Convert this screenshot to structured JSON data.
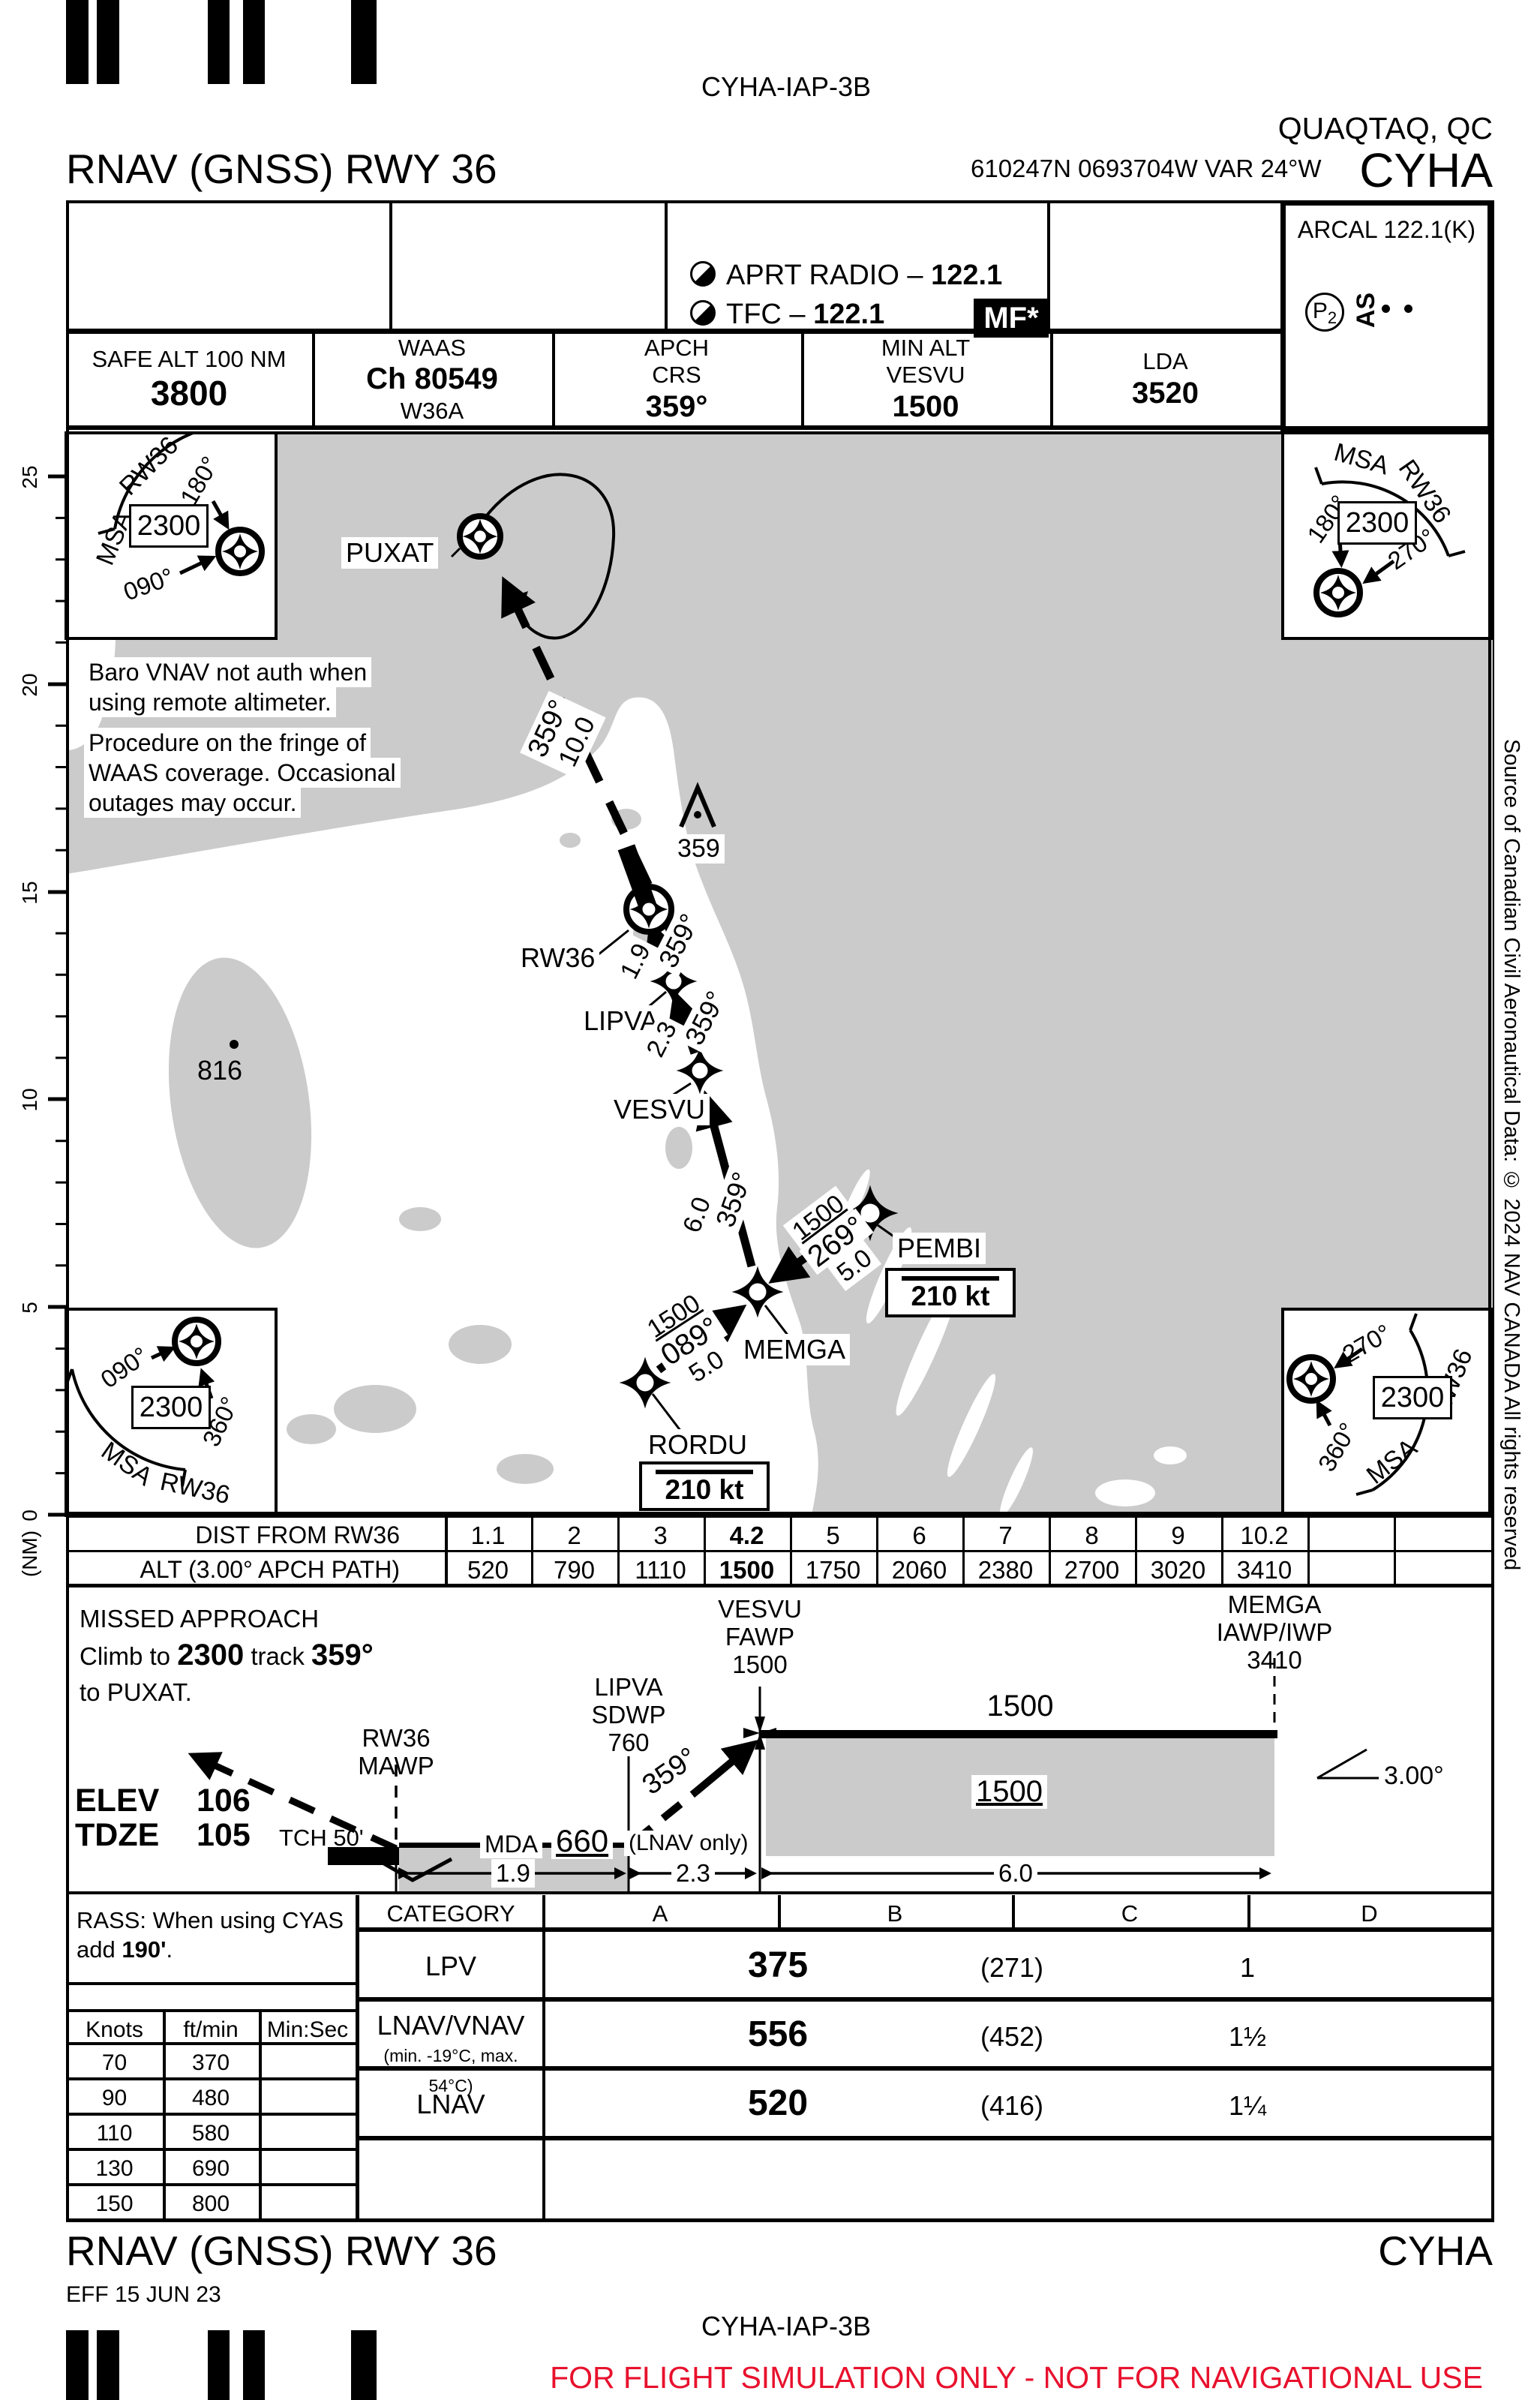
{
  "colors": {
    "warning_red": "#e8112d",
    "land_gray": "#cbcbcb",
    "ink": "#000000"
  },
  "page": {
    "chart_id_top": "CYHA-IAP-3B",
    "city": "QUAQTAQ, QC",
    "airport_code": "CYHA",
    "procedure_title": "RNAV (GNSS) RWY 36",
    "position_line": "610247N  0693704W  VAR 24°W",
    "side_credit": "Source of Canadian Civil Aeronautical Data: © 2024 NAV CANADA All rights reserved",
    "footer_title": "RNAV (GNSS) RWY 36",
    "footer_code": "CYHA",
    "effective": "EFF 15 JUN 23",
    "chart_id_bottom": "CYHA-IAP-3B",
    "warning": "FOR FLIGHT SIMULATION ONLY - NOT FOR NAVIGATIONAL USE"
  },
  "header": {
    "radio_aprt_label": "APRT RADIO – ",
    "radio_aprt_freq": "122.1",
    "radio_tfc_label": "TFC – ",
    "radio_tfc_freq": "122.1",
    "mf_badge": "MF*",
    "arcal": "ARCAL 122.1(K)",
    "p2": "P",
    "p2_sub": "2",
    "as_label": "AS",
    "safe_alt_label": "SAFE ALT 100 NM",
    "safe_alt": "3800",
    "waas_label": "WAAS",
    "waas_channel": "Ch 80549",
    "waas_id": "W36A",
    "apch_label_1": "APCH",
    "apch_label_2": "CRS",
    "apch_crs": "359°",
    "min_alt_label": "MIN ALT",
    "min_alt_fix": "VESVU",
    "min_alt": "1500",
    "lda_label": "LDA",
    "lda": "3520"
  },
  "msa": {
    "title_msa": "MSA",
    "title_rwy": "RW36",
    "altitude": "2300",
    "tl": {
      "b1": "180°",
      "b2": "090°"
    },
    "tr": {
      "b1": "180°",
      "b2": "270°"
    },
    "bl": {
      "b1": "090°",
      "b2": "360°"
    },
    "br": {
      "b1": "270°",
      "b2": "360°"
    }
  },
  "plan": {
    "note1_l1": "Baro VNAV not auth when",
    "note1_l2": "using remote altimeter.",
    "note2_l1": "Procedure on the fringe of",
    "note2_l2": "WAAS coverage. Occasional",
    "note2_l3": "outages may occur.",
    "puxat": "PUXAT",
    "rw36": "RW36",
    "lipva": "LIPVA",
    "vesvu": "VESVU",
    "memga": "MEMGA",
    "pembi": "PEMBI",
    "rordu": "RORDU",
    "pembi_speed": "210 kt",
    "rordu_speed": "210 kt",
    "obstacle_elev": "359",
    "spot_elev": "816",
    "leg_missed_crs": "359°",
    "leg_missed_dist": "10.0",
    "leg1_crs": "359°",
    "leg1_dist": "1.9",
    "leg2_crs": "359°",
    "leg2_dist": "2.3",
    "leg3_crs": "359°",
    "leg3_dist": "6.0",
    "leg4_alt": "1500",
    "leg4_crs": "089°",
    "leg4_dist": "5.0",
    "leg5_alt": "1500",
    "leg5_crs": "269°",
    "leg5_dist": "5.0"
  },
  "scale": {
    "unit": "(NM)",
    "labels": [
      "25",
      "20",
      "15",
      "10",
      "5",
      "0"
    ]
  },
  "dist_table": {
    "dist_label": "DIST FROM RW36",
    "alt_label": "ALT (3.00° APCH PATH)",
    "distances": [
      "1.1",
      "2",
      "3",
      "4.2",
      "5",
      "6",
      "7",
      "8",
      "9",
      "10.2"
    ],
    "altitudes": [
      "520",
      "790",
      "1110",
      "1500",
      "1750",
      "2060",
      "2380",
      "2700",
      "3020",
      "3410"
    ]
  },
  "profile": {
    "missed_1": "MISSED APPROACH",
    "missed_2a": "Climb to ",
    "missed_2b": "2300",
    "missed_2c": " track ",
    "missed_2d": "359°",
    "missed_3": "to PUXAT.",
    "vesvu_name": "VESVU",
    "vesvu_role": "FAWP",
    "vesvu_alt": "1500",
    "memga_name": "MEMGA",
    "memga_role": "IAWP/IWP",
    "memga_alt": "3410",
    "lipva_name": "LIPVA",
    "lipva_role": "SDWP",
    "lipva_alt": "760",
    "rw36_name": "RW36",
    "rw36_role": "MAWP",
    "level_alt": "1500",
    "level_alt_min": "1500",
    "descent_crs": "359°",
    "angle": "3.00°",
    "mda_label": "MDA",
    "mda": "660",
    "mda_note": "(LNAV only)",
    "elev_label": "ELEV",
    "elev": "106",
    "tdze_label": "TDZE",
    "tdze": "105",
    "tch": "TCH 50'",
    "d1": "1.9",
    "d2": "2.3",
    "d3": "6.0"
  },
  "minima": {
    "rass_1": "RASS: When using CYAS",
    "rass_2a": "add ",
    "rass_2b": "190'",
    "rass_2c": ".",
    "category_label": "CATEGORY",
    "cat_a": "A",
    "cat_b": "B",
    "cat_c": "C",
    "cat_d": "D",
    "rows": [
      {
        "label": "LPV",
        "label_note": "",
        "height": "375",
        "hat": "(271)",
        "vis": "1"
      },
      {
        "label": "LNAV/VNAV",
        "label_note": "(min. -19°C, max. 54°C)",
        "height": "556",
        "hat": "(452)",
        "vis": "1½"
      },
      {
        "label": "LNAV",
        "label_note": "",
        "height": "520",
        "hat": "(416)",
        "vis": "1¼"
      }
    ]
  },
  "rates": {
    "h_knots": "Knots",
    "h_fpm": "ft/min",
    "h_minsec": "Min:Sec",
    "rows": [
      {
        "knots": "70",
        "fpm": "370"
      },
      {
        "knots": "90",
        "fpm": "480"
      },
      {
        "knots": "110",
        "fpm": "580"
      },
      {
        "knots": "130",
        "fpm": "690"
      },
      {
        "knots": "150",
        "fpm": "800"
      }
    ]
  }
}
